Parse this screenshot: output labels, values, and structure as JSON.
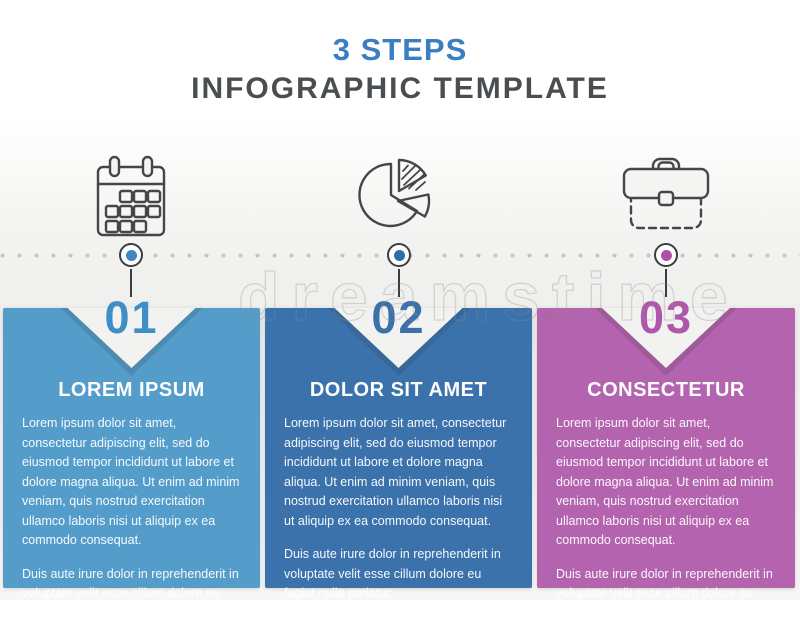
{
  "title": {
    "line1": "3 STEPS",
    "line2": "INFOGRAPHIC TEMPLATE"
  },
  "watermark": {
    "brand": "dreamstime",
    "reg": "®",
    "color": "#8c8c8c"
  },
  "ui_colors": {
    "title_accent": "#3b7fc1",
    "title_gray": "#4b4e50",
    "icon_stroke": "#43474a",
    "timeline_dot": "#c5c5c3",
    "marker_ring": "#3a3e41"
  },
  "steps": [
    {
      "number": "01",
      "icon": "calendar",
      "heading": "LOREM IPSUM",
      "body": [
        "Lorem ipsum dolor sit amet, consectetur adipiscing elit, sed do eiusmod tempor incididunt ut labore et dolore magna aliqua. Ut enim ad minim veniam, quis nostrud exercitation ullamco laboris nisi ut aliquip ex ea commodo consequat.",
        "Duis aute irure dolor in reprehenderit in voluptate velit esse cillum dolore eu fugiat nulla pariatur."
      ],
      "colors": {
        "panel": "#549dca",
        "number": "#3f8ec6",
        "dot": "#3f87c0"
      }
    },
    {
      "number": "02",
      "icon": "pie-chart",
      "heading": "DOLOR SIT AMET",
      "body": [
        "Lorem ipsum dolor sit amet, consectetur adipiscing elit, sed do eiusmod tempor incididunt ut labore et dolore magna aliqua. Ut enim ad minim veniam, quis nostrud exercitation ullamco laboris nisi ut aliquip ex ea commodo consequat.",
        "Duis aute irure dolor in reprehenderit in voluptate velit esse cillum dolore eu fugiat nulla pariatur."
      ],
      "colors": {
        "panel": "#3b72ac",
        "number": "#3c70a9",
        "dot": "#2f6ca8"
      }
    },
    {
      "number": "03",
      "icon": "briefcase",
      "heading": "CONSECTETUR",
      "body": [
        "Lorem ipsum dolor sit amet, consectetur adipiscing elit, sed do eiusmod tempor incididunt ut labore et dolore magna aliqua. Ut enim ad minim veniam, quis nostrud exercitation ullamco laboris nisi ut aliquip ex ea commodo consequat.",
        "Duis aute irure dolor in reprehenderit in voluptate velit esse cillum dolore eu fugiat nulla pariatur."
      ],
      "colors": {
        "panel": "#b463af",
        "number": "#b157ab",
        "dot": "#b04fa8"
      }
    }
  ]
}
